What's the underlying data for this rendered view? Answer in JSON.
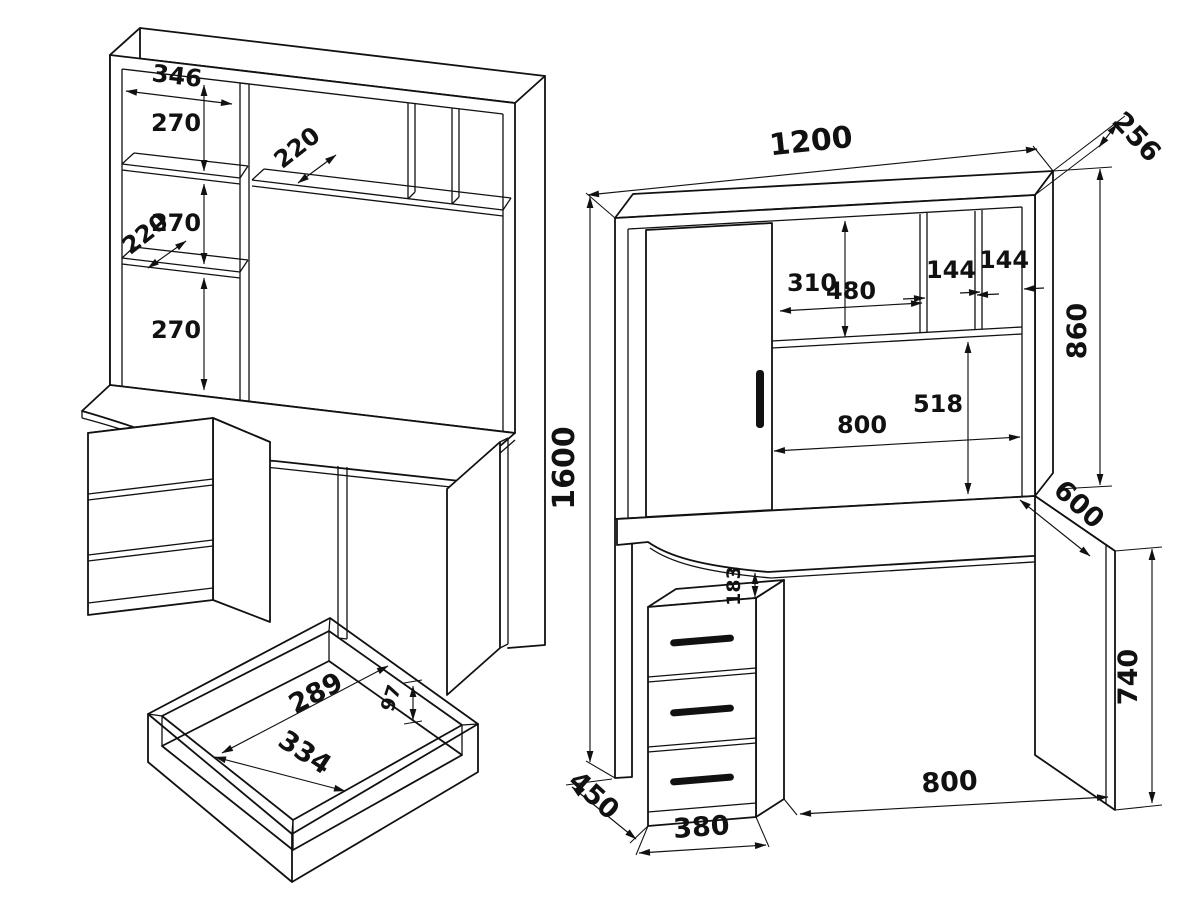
{
  "diagram": {
    "background": "#ffffff",
    "ink": "#111111",
    "iso_view": {
      "dims": {
        "shelf_inner_width": "346",
        "shelf_gap_1": "270",
        "shelf_gap_2": "270",
        "shelf_gap_3": "270",
        "left_shelf_depth": "220",
        "right_shelf_depth": "220"
      }
    },
    "box_view": {
      "dims": {
        "inner_width": "289",
        "inner_length": "334",
        "inner_height": "97"
      }
    },
    "front_view": {
      "dims": {
        "overall_width": "1200",
        "top_depth": "256",
        "overall_height": "1600",
        "hutch_height": "860",
        "cubby_height": "310",
        "shelf_opening_width": "480",
        "slot_width_1": "144",
        "slot_width_2": "144",
        "niche_height": "518",
        "niche_width": "800",
        "desktop_depth": "600",
        "desktop_cabinet_gap": "183",
        "desk_height": "740",
        "base_depth": "450",
        "cabinet_width": "380",
        "knee_width": "800"
      }
    }
  }
}
